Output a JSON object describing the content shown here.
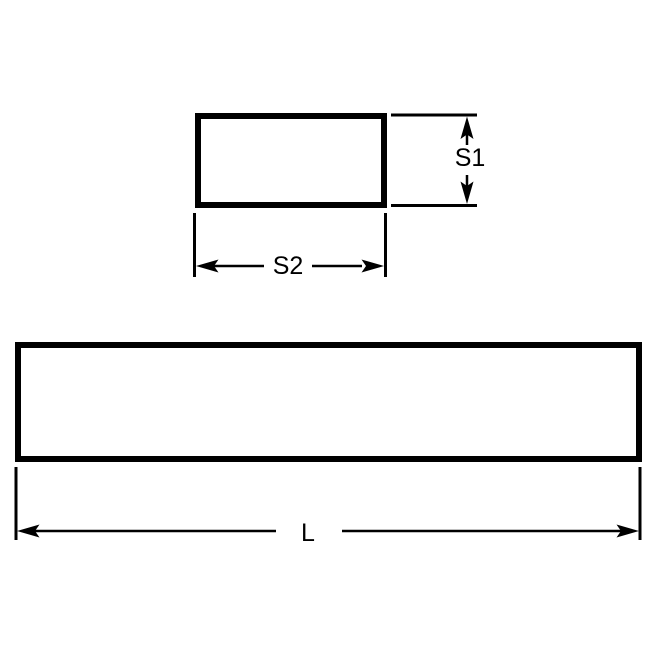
{
  "drawing": {
    "cross_section_view": {
      "height_label": "S1",
      "width_label": "S2"
    },
    "side_view": {
      "length_label": "L"
    }
  },
  "colors": {
    "background": "#ffffff",
    "line": "#000000",
    "text": "#000000"
  },
  "icons": {
    "arrows": [
      "arrow-up-icon",
      "arrow-down-icon",
      "arrow-left-icon",
      "arrow-right-icon"
    ]
  }
}
